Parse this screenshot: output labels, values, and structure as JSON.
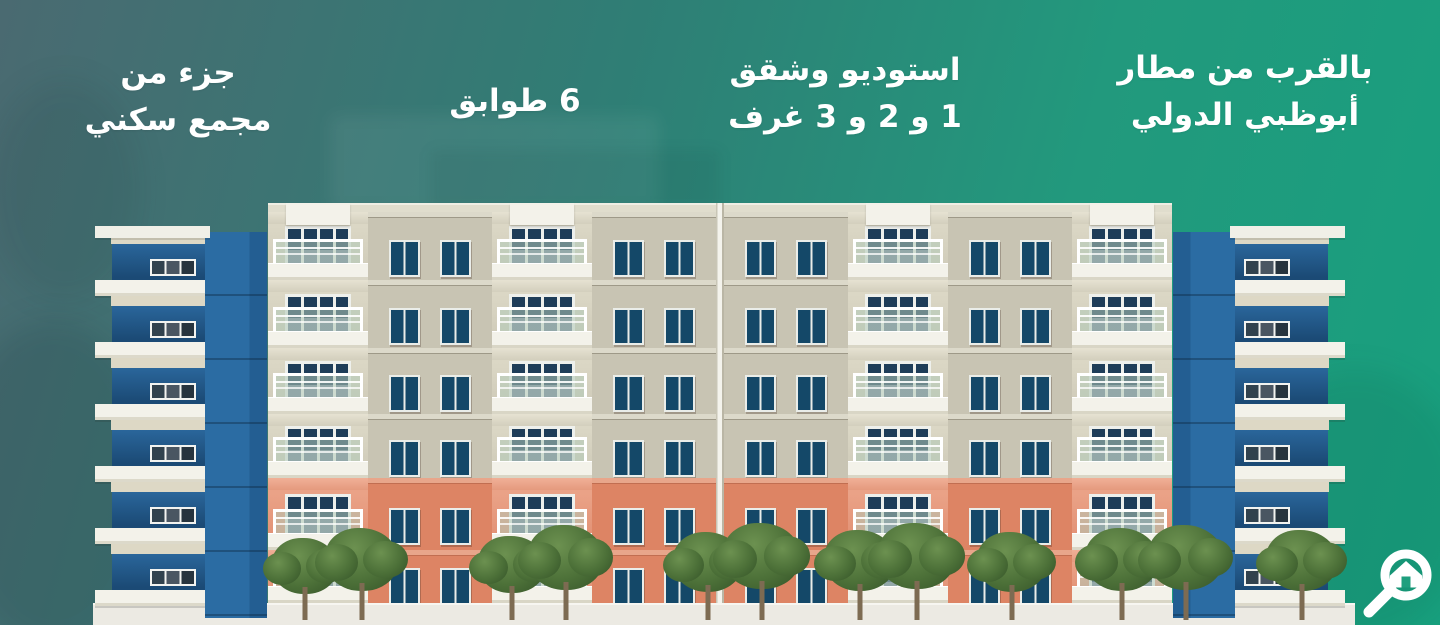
{
  "feature_labels": [
    {
      "id": "residential-complex",
      "lines": [
        "جزء من",
        "مجمع سكني"
      ]
    },
    {
      "id": "floors-count",
      "lines": [
        "6 طوابق"
      ]
    },
    {
      "id": "unit-types",
      "lines": [
        "استوديو وشقق",
        "1 و 2 و 3 غرف"
      ]
    },
    {
      "id": "airport-proximity",
      "lines": [
        "بالقرب من مطار",
        "أبوظبي الدولي"
      ]
    }
  ],
  "icons": {
    "logo": "magnifier-house-logo"
  },
  "colors": {
    "background_left": "#4a6a71",
    "background_right": "#18a07e",
    "wall_cream": "#c8c4b3",
    "wall_orange": "#dd8464",
    "window_blue": "#144868",
    "tower_blue": "#2b6ca3",
    "slab_white": "#f3f2ea",
    "canopy_green": "#4c7038",
    "canopy_green_light": "#6c9150",
    "text_white": "#ffffff"
  },
  "illustration": {
    "floors": 6,
    "facade": {
      "column_pattern": [
        "B",
        "W",
        "B",
        "W",
        "D",
        "W",
        "B",
        "W",
        "B"
      ],
      "column_widths": {
        "B": 100,
        "W": 124,
        "D": 8
      },
      "floor_heights": [
        68,
        68,
        66,
        64,
        72,
        53
      ],
      "floor_types": [
        "cream",
        "cream",
        "cream",
        "cream",
        "orange",
        "orange"
      ],
      "window_tops": [
        28,
        28,
        27,
        26,
        30,
        18
      ],
      "door_tops": [
        14,
        14,
        13,
        12,
        16,
        8
      ]
    },
    "wings": {
      "rows": 6
    },
    "trees": [
      [
        305,
        78
      ],
      [
        362,
        88
      ],
      [
        512,
        80
      ],
      [
        566,
        90
      ],
      [
        708,
        84
      ],
      [
        762,
        92
      ],
      [
        860,
        86
      ],
      [
        917,
        92
      ],
      [
        1012,
        84
      ],
      [
        1122,
        88
      ],
      [
        1186,
        90
      ],
      [
        1302,
        86
      ]
    ]
  }
}
